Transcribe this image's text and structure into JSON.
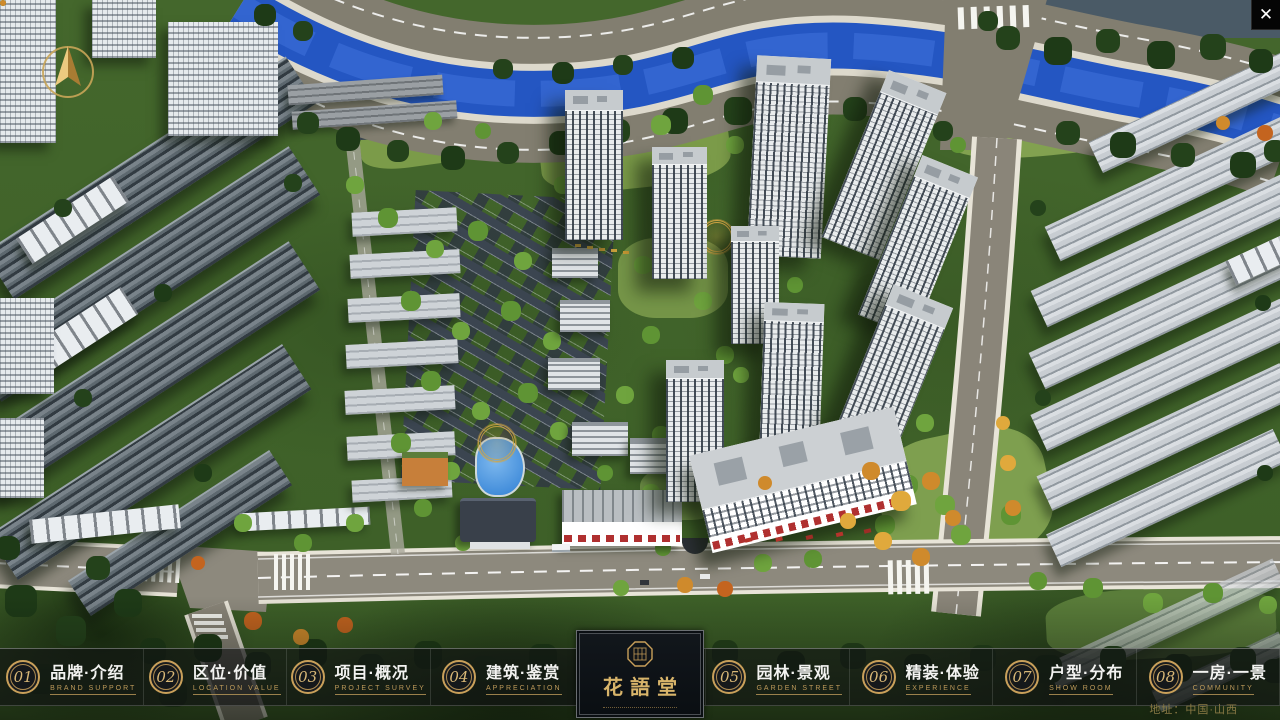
{
  "window": {
    "close_label": "✕"
  },
  "navbar": {
    "items": [
      {
        "num": "01",
        "zh": "品牌·介绍",
        "en": "BRAND SUPPORT"
      },
      {
        "num": "02",
        "zh": "区位·价值",
        "en": "LOCATION VALUE"
      },
      {
        "num": "03",
        "zh": "项目·概况",
        "en": "PROJECT SURVEY"
      },
      {
        "num": "04",
        "zh": "建筑·鉴赏",
        "en": "APPRECIATION"
      },
      {
        "num": "05",
        "zh": "园林·景观",
        "en": "GARDEN STREET"
      },
      {
        "num": "06",
        "zh": "精装·体验",
        "en": "EXPERIENCE"
      },
      {
        "num": "07",
        "zh": "户型·分布",
        "en": "SHOW ROOM"
      },
      {
        "num": "08",
        "zh": "一房·一景",
        "en": "COMMUNITY"
      }
    ]
  },
  "logo": {
    "title": "花語堂"
  },
  "footer": {
    "address": "地址：中国·山西"
  },
  "colors": {
    "gold": "#c9a05a",
    "river": "#2456c2",
    "bar_bg": "rgba(16,18,20,0.62)"
  }
}
